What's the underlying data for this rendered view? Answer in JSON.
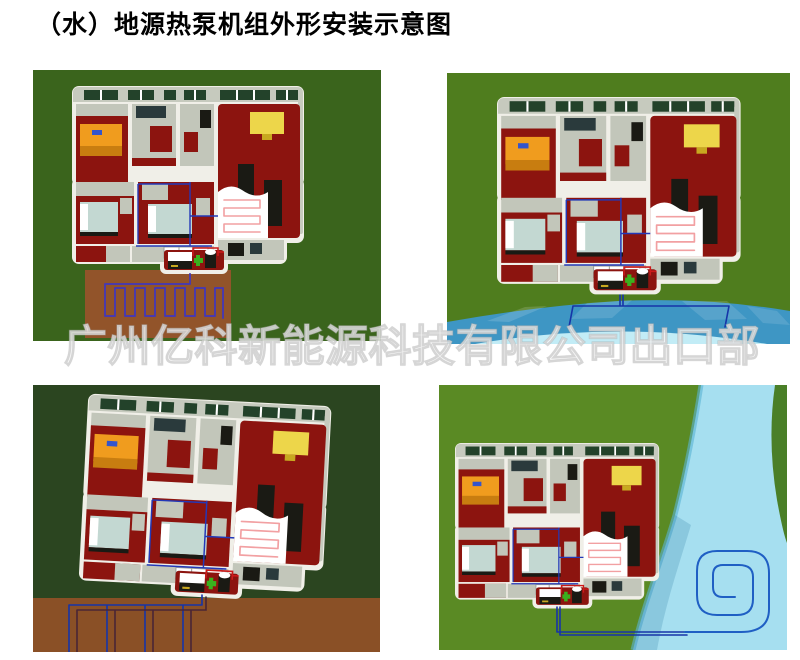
{
  "title": "（水）地源热泵机组外形安装示意图",
  "watermark": "广州亿科新能源科技有限公司出口部",
  "panels": [
    {
      "id": "horizontal-ground-loop",
      "scene": "house-with-horizontal-trench-ground-loop"
    },
    {
      "id": "pond-loop",
      "scene": "house-with-pond-water-loop"
    },
    {
      "id": "vertical-ground-loop",
      "scene": "house-with-vertical-borehole-ground-loop"
    },
    {
      "id": "river-coil-loop",
      "scene": "house-with-river-spiral-coil-loop"
    }
  ],
  "colors": {
    "panel1_grass": "#3a641c",
    "panel1_soil": "#92542a",
    "panel2_grass": "#4f7d1e",
    "panel2_water": "#3e96c4",
    "panel2_water_light": "#c2ecf6",
    "panel3_grass": "#2b4520",
    "panel3_soil": "#8a5026",
    "panel4_grass": "#5a8a24",
    "panel4_river": "#a6dff0",
    "panel4_bank_green": "#4a7f28",
    "house_wall": "#f0efe8",
    "house_wall_top": "#c6cabe",
    "floor_red": "#8c140f",
    "floor_gray": "#c2c6ba",
    "window_green": "#23422a",
    "furniture_orange": "#f09c1e",
    "furniture_yellow": "#edd64a",
    "furniture_black": "#1a1a14",
    "bed_gray": "#c3d8d2",
    "pipe_blue": "#2338b8",
    "pipe_red": "#cc1a1a",
    "loop_purple": "#4a3aaa",
    "coil_pink": "#f2a0a2",
    "spiral_blue": "#1f5fc4",
    "watermark": "rgba(255,255,255,0.78)",
    "title_text": "#000000"
  }
}
